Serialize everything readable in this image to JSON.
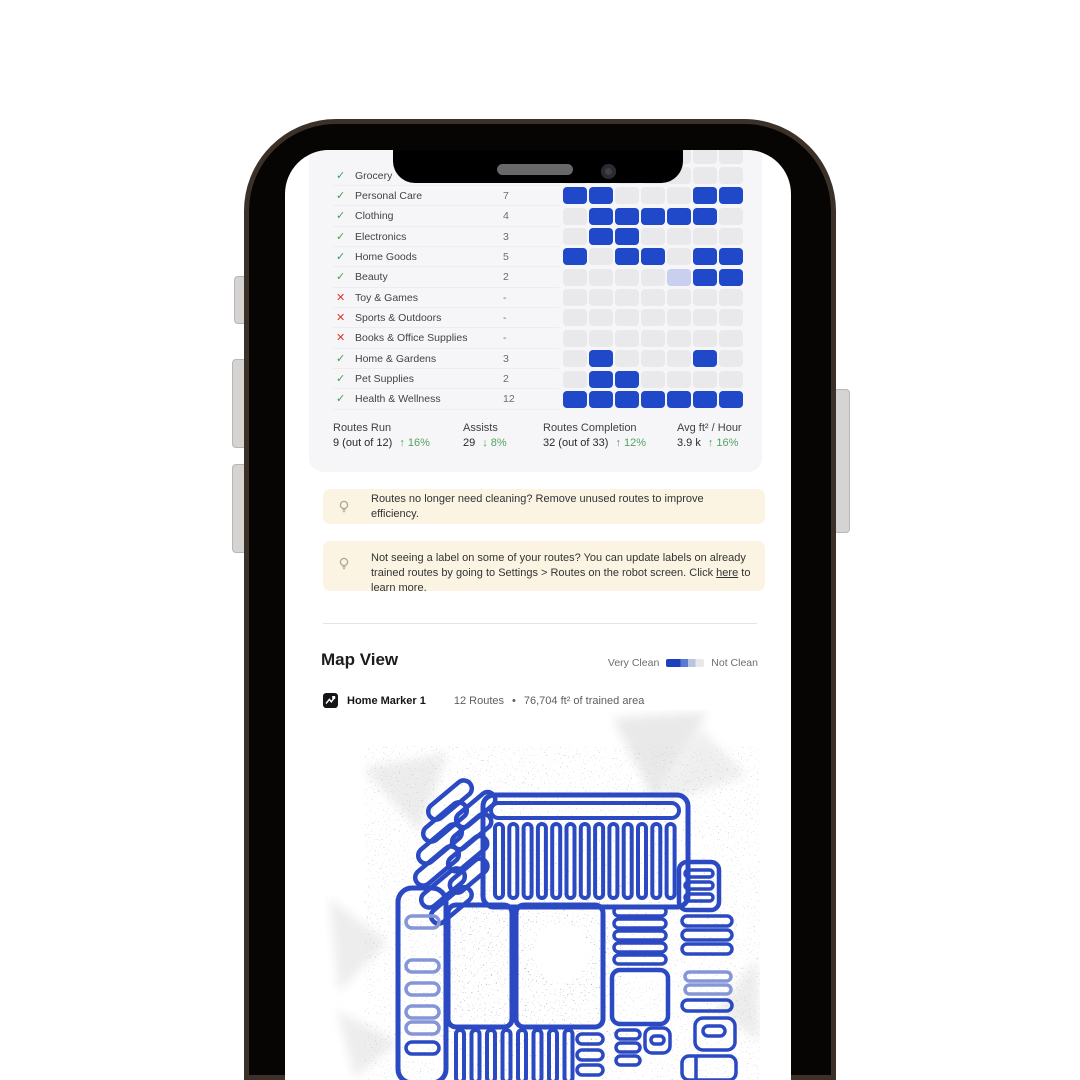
{
  "colors": {
    "accent_blue": "#1f49c9",
    "cell_low": "#c9cfee",
    "cell_empty": "#e9e9eb",
    "check_green": "#3da05a",
    "cross_red": "#d9382c",
    "delta_green": "#55a263",
    "banner_bg": "#fbf4e2",
    "map_blue": "#2a49c2"
  },
  "icons": {
    "done": "✓",
    "missed": "✕",
    "up_arrow": "↑",
    "down_arrow": "↓",
    "dot": "•"
  },
  "categories": [
    {
      "label": "Grocery",
      "status": "done",
      "count": ""
    },
    {
      "label": "Personal Care",
      "status": "done",
      "count": "7"
    },
    {
      "label": "Clothing",
      "status": "done",
      "count": "4"
    },
    {
      "label": "Electronics",
      "status": "done",
      "count": "3"
    },
    {
      "label": "Home Goods",
      "status": "done",
      "count": "5"
    },
    {
      "label": "Beauty",
      "status": "done",
      "count": "2"
    },
    {
      "label": "Toy & Games",
      "status": "missed",
      "count": "-"
    },
    {
      "label": "Sports & Outdoors",
      "status": "missed",
      "count": "-"
    },
    {
      "label": "Books & Office Supplies",
      "status": "missed",
      "count": "-"
    },
    {
      "label": "Home & Gardens",
      "status": "done",
      "count": "3"
    },
    {
      "label": "Pet Supplies",
      "status": "done",
      "count": "2"
    },
    {
      "label": "Health & Wellness",
      "status": "done",
      "count": "12"
    }
  ],
  "activity_grid": {
    "columns": 7,
    "partial_top_row": "0000000",
    "rows": [
      "0000000",
      "1100011",
      "0111110",
      "0110000",
      "1011011",
      "0000L11",
      "0000000",
      "0000000",
      "0000000",
      "0100010",
      "0110000",
      "1111111"
    ]
  },
  "stats": [
    {
      "label": "Routes Run",
      "value": "9 (out of 12)",
      "delta": "16%",
      "direction": "up"
    },
    {
      "label": "Assists",
      "value": "29",
      "delta": "8%",
      "direction": "down"
    },
    {
      "label": "Routes Completion",
      "value": "32 (out of 33)",
      "delta": "12%",
      "direction": "up"
    },
    {
      "label": "Avg ft² / Hour",
      "value": "3.9 k",
      "delta": "16%",
      "direction": "up"
    }
  ],
  "tips": [
    {
      "segments": [
        {
          "text": "Routes no longer need cleaning? Remove unused routes to improve efficiency."
        }
      ]
    },
    {
      "segments": [
        {
          "text": "Not seeing a label on some of your routes? You can update labels on already trained routes by going to Settings > Routes on the robot screen. Click "
        },
        {
          "text": "here",
          "link": true
        },
        {
          "text": " to learn more."
        }
      ]
    }
  ],
  "map_view": {
    "title": "Map View",
    "legend_left": "Very Clean",
    "legend_right": "Not Clean",
    "marker_name": "Home Marker 1",
    "routes_count": "12 Routes",
    "separator": "•",
    "trained_area": "76,704 ft² of trained area"
  }
}
